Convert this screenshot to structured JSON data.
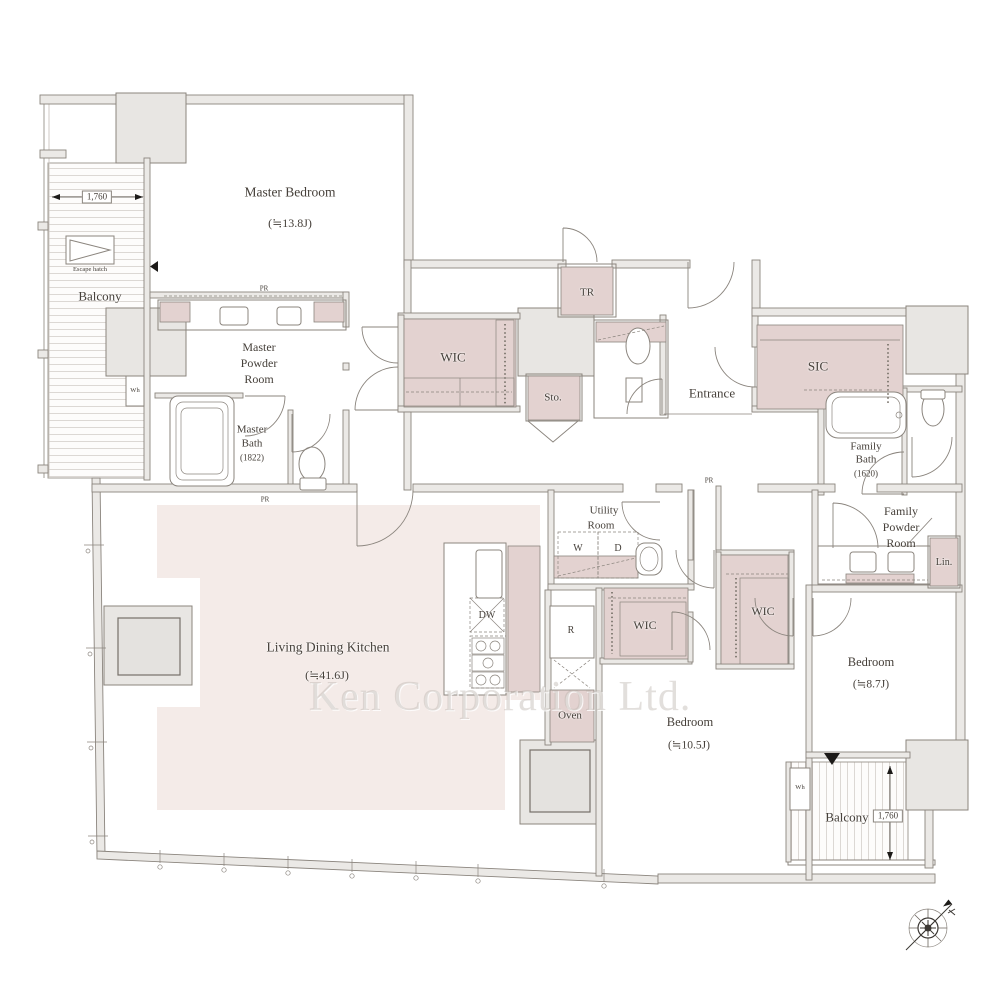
{
  "plan": {
    "watermark": "Ken Corporation Ltd.",
    "rooms": {
      "master_bedroom": {
        "name": "Master Bedroom",
        "size": "(≒13.8J)"
      },
      "balcony_left": {
        "name": "Balcony",
        "width_dim": "1,760",
        "escape_hatch": "Escape hatch"
      },
      "master_powder_room": {
        "line1": "Master",
        "line2": "Powder",
        "line3": "Room"
      },
      "master_bath": {
        "line1": "Master",
        "line2": "Bath",
        "size": "(1822)"
      },
      "wic_master": {
        "name": "WIC"
      },
      "trunk_room": {
        "name": "TR"
      },
      "storage": {
        "name": "Sto."
      },
      "entrance": {
        "name": "Entrance"
      },
      "sic": {
        "name": "SIC"
      },
      "family_bath": {
        "line1": "Family",
        "line2": "Bath",
        "size": "(1620)"
      },
      "family_powder_room": {
        "line1": "Family",
        "line2": "Powder",
        "line3": "Room"
      },
      "linen": {
        "name": "Lin."
      },
      "utility_room": {
        "line1": "Utility",
        "line2": "Room",
        "washer": "W",
        "dryer": "D"
      },
      "wic_bedroom2": {
        "name": "WIC"
      },
      "wic_bedroom3": {
        "name": "WIC"
      },
      "bedroom2": {
        "name": "Bedroom",
        "size": "(≒10.5J)"
      },
      "bedroom3": {
        "name": "Bedroom",
        "size": "(≒8.7J)"
      },
      "ldk": {
        "name": "Living Dining Kitchen",
        "size": "(≒41.6J)"
      },
      "kitchen": {
        "dishwasher": "DW",
        "refrigerator": "R",
        "oven": "Oven"
      },
      "balcony_right": {
        "name": "Balcony",
        "height_dim": "1,760"
      },
      "water_heater": "Wh",
      "pipe_rack": "PR"
    },
    "colors": {
      "closet_fill": "#e3d2d0",
      "wall_fill": "#ebe9e6",
      "floor_tint": "#f4ebe8",
      "line": "#8b857e",
      "text": "#46403a"
    }
  }
}
